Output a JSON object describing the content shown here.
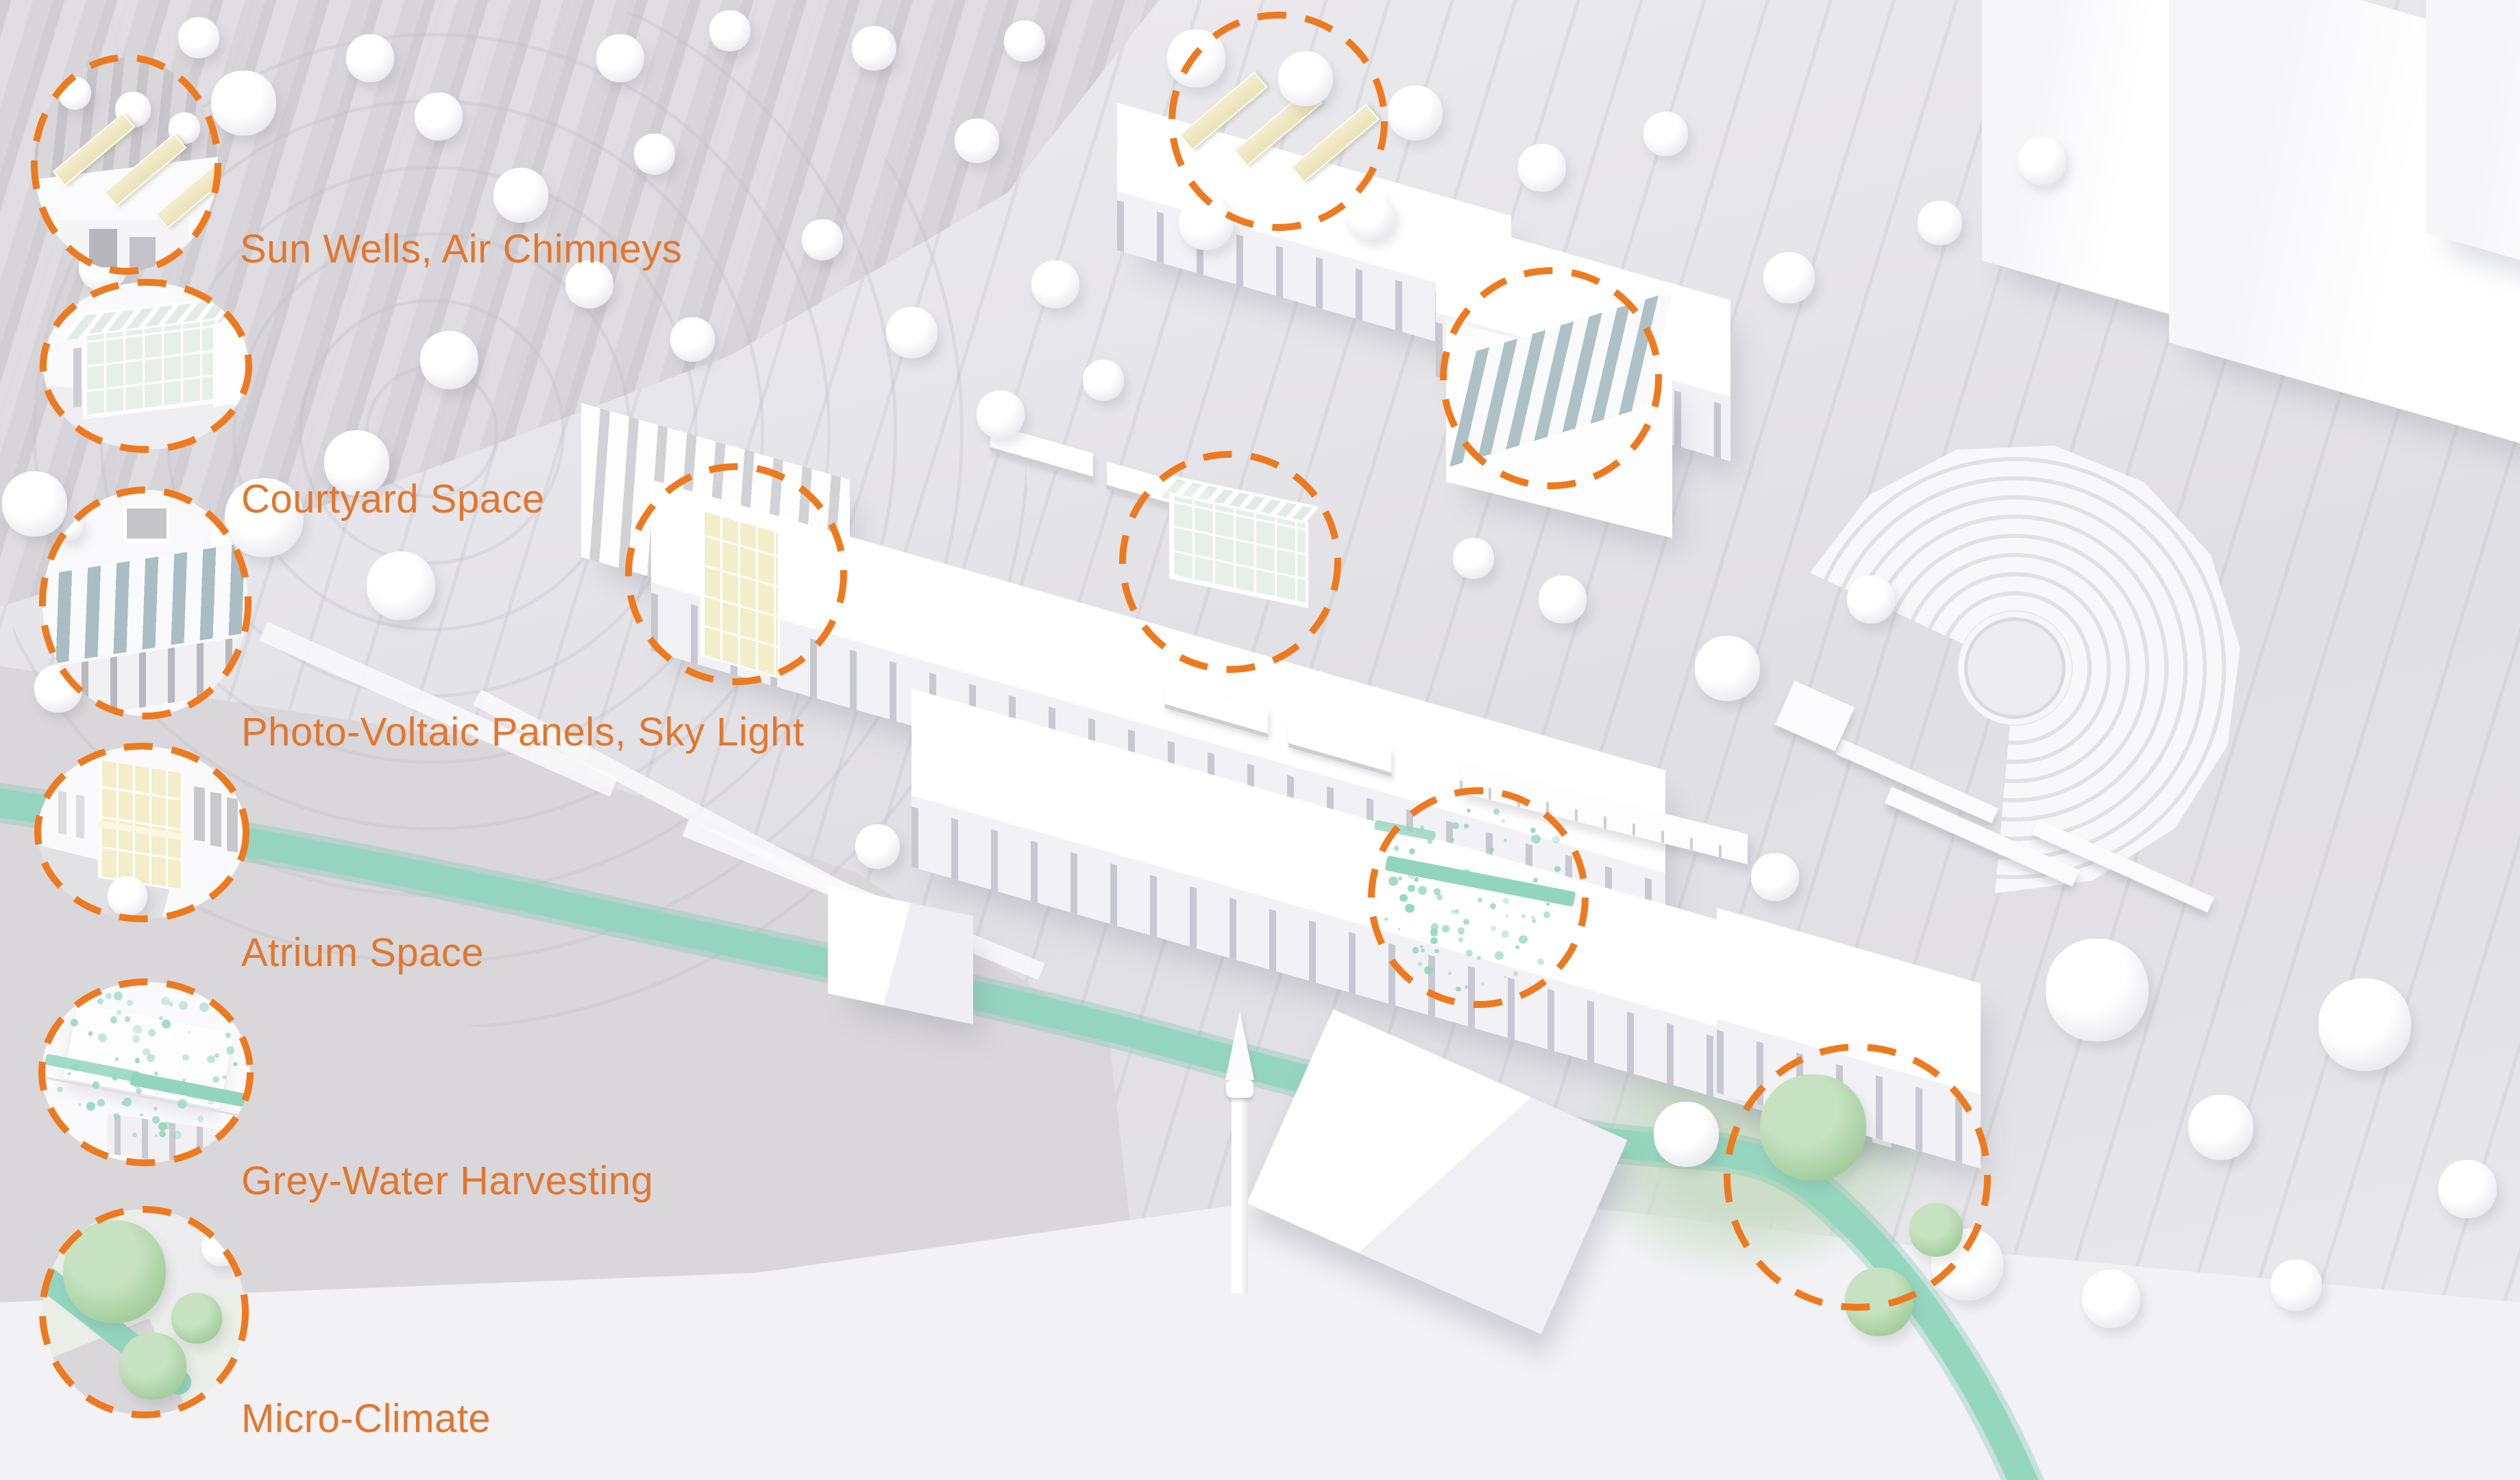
{
  "legend": {
    "items": [
      {
        "id": "sun-wells",
        "label": "Sun Wells, Air Chimneys"
      },
      {
        "id": "courtyard",
        "label": "Courtyard Space"
      },
      {
        "id": "pv-panels",
        "label": "Photo-Voltaic Panels, Sky Light"
      },
      {
        "id": "atrium",
        "label": "Atrium Space"
      },
      {
        "id": "grey-water",
        "label": "Grey-Water Harvesting"
      },
      {
        "id": "micro-climate",
        "label": "Micro-Climate"
      }
    ]
  },
  "colors": {
    "accent_orange": "#ee7a1f",
    "label_orange": "#e2772e",
    "water_teal": "#92d5be",
    "sunwell_yellow": "#ece2b5",
    "atrium_yellow": "#f3edc9",
    "pv_glass_teal": "#a9bec3",
    "courtyard_glass_green": "#e7efe9",
    "tree_green": "#a6cfa0",
    "terrain_grey": "#d9d7da",
    "model_white": "#ffffff"
  }
}
